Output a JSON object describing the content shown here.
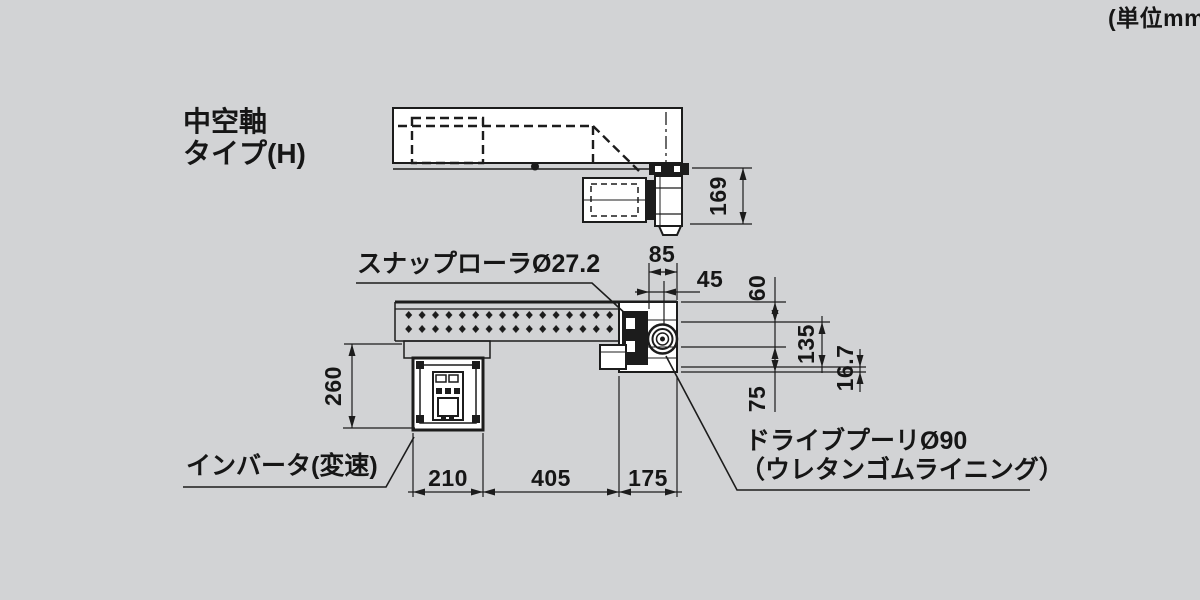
{
  "unit_note": "(単位mm)",
  "labels": {
    "type_line1": "中空軸",
    "type_line2": "タイプ(H)",
    "snap_roller": "スナップローラØ27.2",
    "inverter": "インバータ(変速)",
    "drive_pulley_line1": "ドライブプーリØ90",
    "drive_pulley_line2": "（ウレタンゴムライニング）"
  },
  "dimensions": {
    "drive_unit_height": "169",
    "motor_block_width": "85",
    "pulley_center_offset": "45",
    "top_to_shaft": "60",
    "frame_height": "135",
    "rail_thickness": "16.7",
    "bottom_clearance": "75",
    "inverter_depth": "260",
    "inverter_section": "210",
    "middle_section": "405",
    "head_section": "175"
  },
  "colors": {
    "background": "#d2d3d5",
    "line": "#1c1c1c",
    "fill": "#ffffff"
  }
}
